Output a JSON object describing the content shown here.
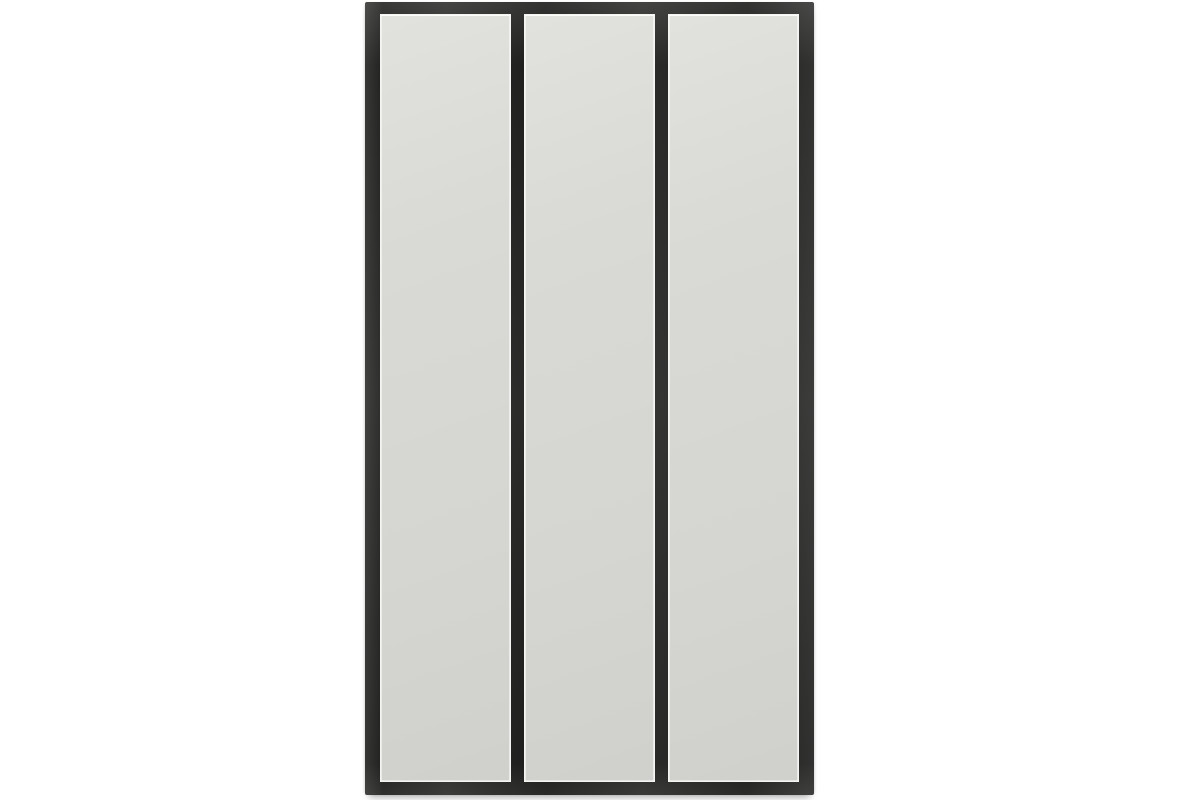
{
  "scene": {
    "type": "product-photograph",
    "subject": "three-panel industrial atelier-style wall mirror with black metal frame",
    "panel_count": 3
  },
  "colors": {
    "background": "#ffffff",
    "frame": "#232322",
    "panel": "#d9d9d5",
    "bevel_highlight": "#f4f4f0",
    "drop_shadow": "rgba(0,0,0,0.35)"
  }
}
